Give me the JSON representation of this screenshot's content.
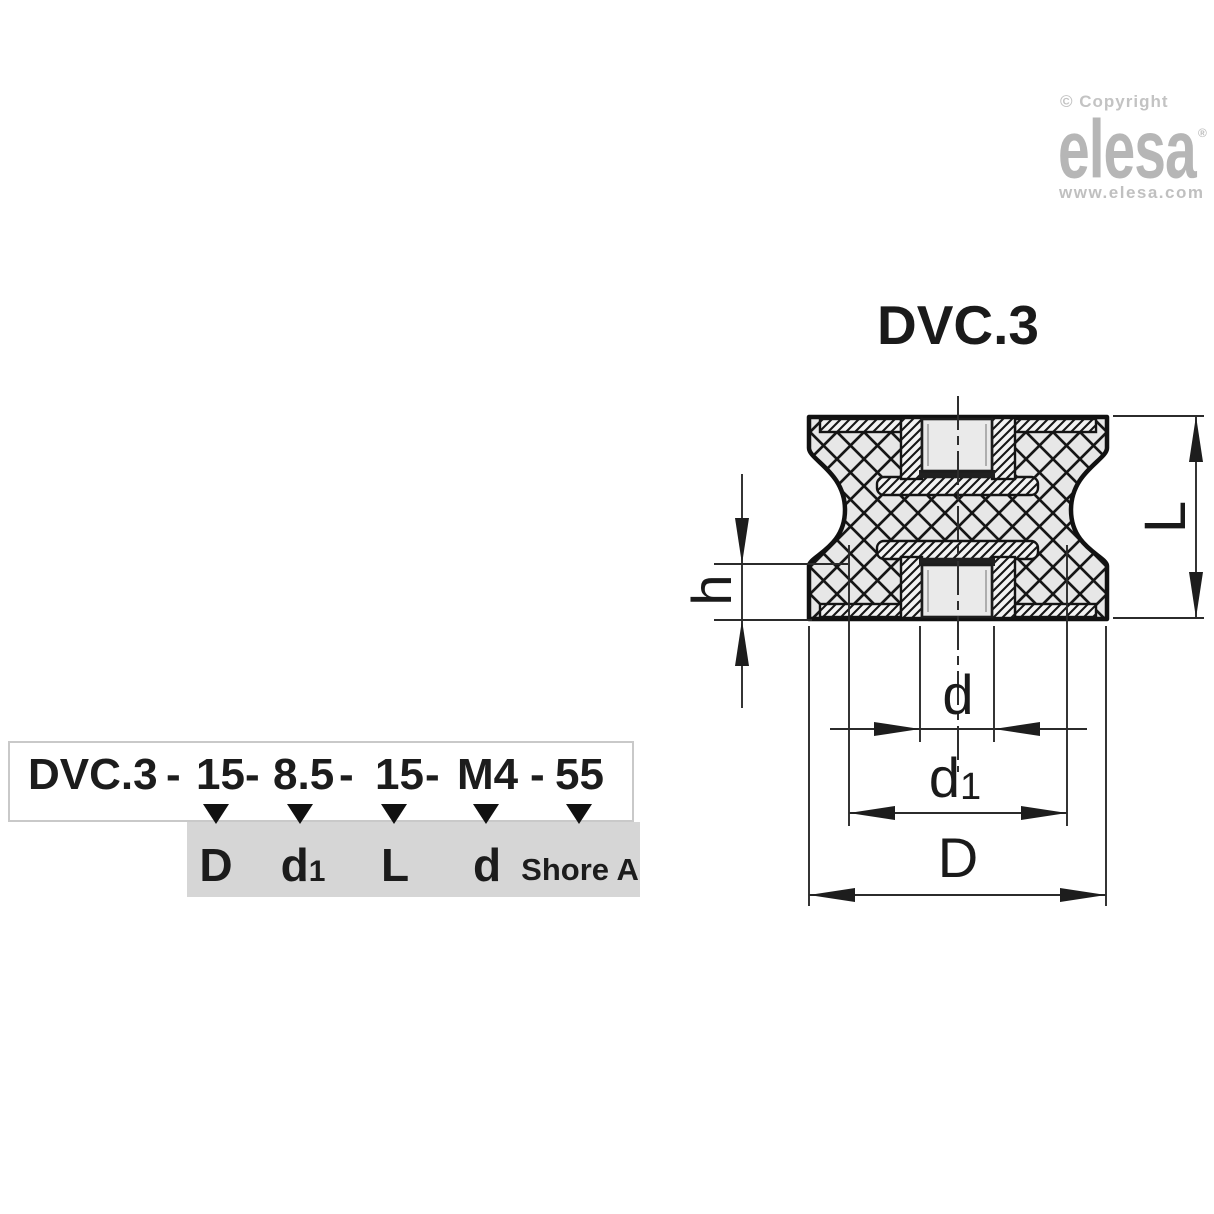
{
  "branding": {
    "copyright": "© Copyright",
    "logo": "elesa",
    "registered": "®",
    "website": "www.elesa.com"
  },
  "drawing": {
    "title": "DVC.3",
    "dims": {
      "L": "L",
      "h": "h",
      "d": "d",
      "d1_base": "d",
      "d1_sub": "1",
      "D": "D"
    }
  },
  "order_code": {
    "full_code": "DVC.3 - 15 - 8.5 - 15 - M4 - 55",
    "parts": [
      "DVC.3",
      "-",
      "15",
      "-",
      "8.5",
      "-",
      "15",
      "-",
      "M4",
      "-",
      "55"
    ],
    "labels": {
      "l1": "D",
      "l2_base": "d",
      "l2_sub": "1",
      "l3": "L",
      "l4": "d",
      "l5": "Shore A"
    }
  },
  "colors": {
    "logo_gray": "#b6b6b6",
    "label_box_gray": "#d6d6d6",
    "line_black": "#1a1a1a",
    "rubber_fill": "#e7e7e7"
  }
}
